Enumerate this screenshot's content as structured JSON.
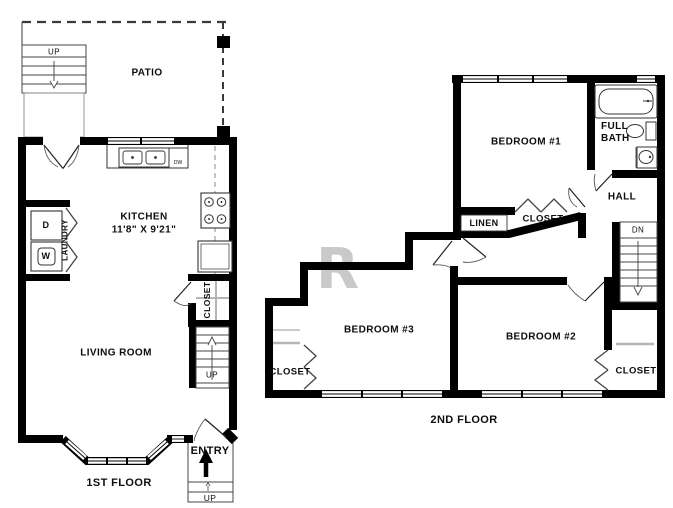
{
  "watermark": "R",
  "first_floor": {
    "floor_label": "1ST FLOOR",
    "patio": {
      "label": "PATIO",
      "stairs_label": "UP"
    },
    "kitchen": {
      "label": "KITCHEN",
      "dimensions": "11'8\" X 9'21\"",
      "dishwasher": "DW"
    },
    "laundry": {
      "label": "LAUNDRY",
      "dryer": "D",
      "washer": "W"
    },
    "closet": {
      "label": "CLOSET"
    },
    "stairs": {
      "label": "UP"
    },
    "living_room": {
      "label": "LIVING ROOM"
    },
    "entry": {
      "label": "ENTRY",
      "steps_label": "UP"
    }
  },
  "second_floor": {
    "floor_label": "2ND FLOOR",
    "bedroom1": {
      "label": "BEDROOM #1",
      "closet_label": "CLOSET"
    },
    "bedroom2": {
      "label": "BEDROOM #2",
      "closet_label": "CLOSET"
    },
    "bedroom3": {
      "label": "BEDROOM #3",
      "closet_label": "CLOSET"
    },
    "full_bath": {
      "line1": "FULL",
      "line2": "BATH"
    },
    "hall": {
      "label": "HALL"
    },
    "linen": {
      "label": "LINEN"
    },
    "stairs": {
      "label": "DN"
    }
  },
  "colors": {
    "wall": "#000000",
    "shelf_gray": "#b5b5b5",
    "watermark_gray": "#c9c9c9"
  }
}
